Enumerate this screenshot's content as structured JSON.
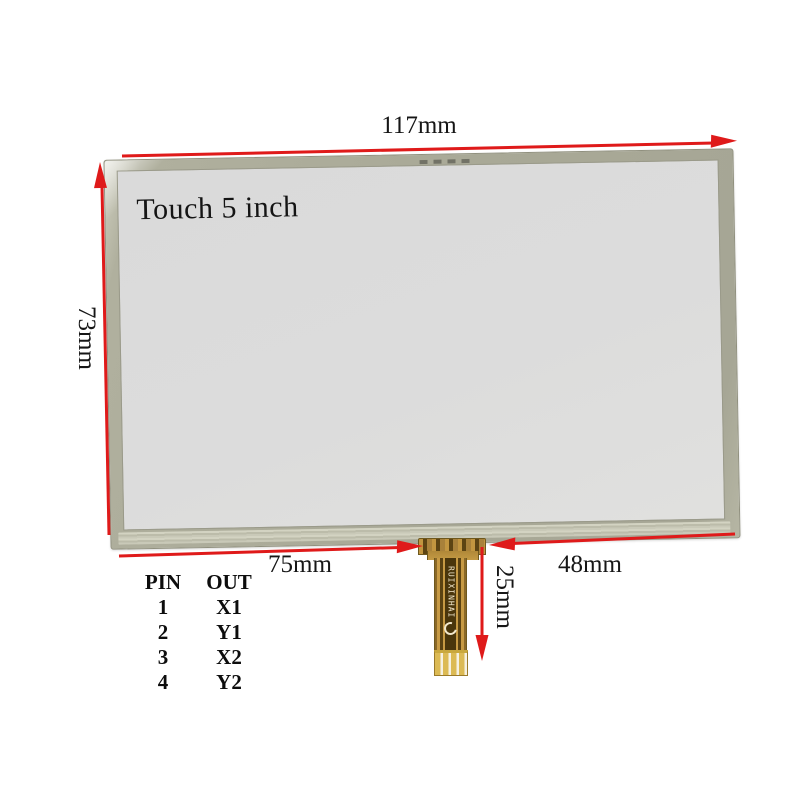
{
  "labels": {
    "screen": "Touch 5 inch",
    "width": "117mm",
    "height": "73mm",
    "bottom_left_width": "75mm",
    "bottom_right_width": "48mm",
    "cable_length": "25mm",
    "cable_brand": "RUIXINHAI"
  },
  "pinout": {
    "col_pin": "PIN",
    "col_out": "OUT",
    "rows": [
      {
        "pin": "1",
        "out": "X1"
      },
      {
        "pin": "2",
        "out": "Y1"
      },
      {
        "pin": "3",
        "out": "X2"
      },
      {
        "pin": "4",
        "out": "Y2"
      }
    ]
  },
  "colors": {
    "arrow_red": "#df1a1a",
    "frame_olive": "#aaaa98",
    "screen_gray": "#dcdcdc",
    "cable_gold": "#c79a44",
    "cable_trace": "#5a4212",
    "finger_gold": "#dcba54"
  }
}
